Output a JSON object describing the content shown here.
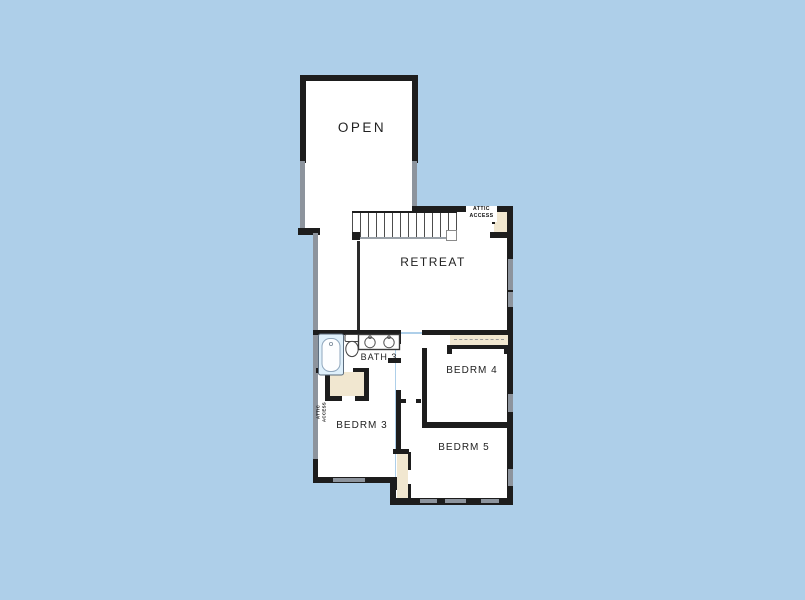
{
  "title": "Second floor plan",
  "colors": {
    "background": "#aecfe9",
    "wall": "#1d1d1d",
    "window_gray": "#8d949d",
    "closet_beige": "#f1e7d0",
    "tub_blue": "#dff0fb",
    "floor_white": "#ffffff"
  },
  "floorplan": {
    "rooms": [
      {
        "id": "open",
        "label": "OPEN"
      },
      {
        "id": "retreat",
        "label": "RETREAT"
      },
      {
        "id": "bath3",
        "label": "BATH 3"
      },
      {
        "id": "bedrm3",
        "label": "BEDRM 3"
      },
      {
        "id": "bedrm4",
        "label": "BEDRM 4"
      },
      {
        "id": "bedrm5",
        "label": "BEDRM 5"
      }
    ],
    "annotations": {
      "attic_access_top": {
        "line1": "ATTIC",
        "line2": "ACCESS"
      },
      "attic_access_side": {
        "line1": "ATTIC",
        "line2": "ACCESS"
      }
    },
    "fixtures": [
      "stairs",
      "bathtub",
      "toilet",
      "double-vanity-sinks",
      "closet-shelving",
      "windows"
    ]
  }
}
